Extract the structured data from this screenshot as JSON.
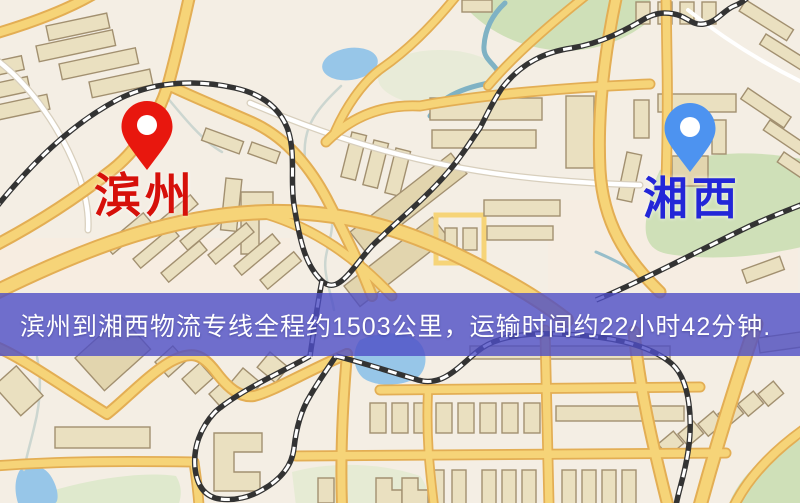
{
  "palette": {
    "origin_pin": "#e8170e",
    "origin_label": "#d6100a",
    "destination_pin": "#4d93f0",
    "destination_label": "#2326d8",
    "banner_bg": "rgba(77,77,197,0.8)",
    "banner_text": "#ffffff",
    "map_base": "#f4eee4",
    "map_patch": "#f8ecdf",
    "road_fill": "#f6d478",
    "road_casing": "#e3ae54",
    "minor_road_fill": "#ffffff",
    "minor_road_casing": "#d8cfbd",
    "building_fill": "#eae0c0",
    "building_dark": "#e2d5ae",
    "building_outline": "#a29070",
    "park": "#cfe0b8",
    "park_light": "#dfe9cd",
    "water": "#97c6e8",
    "stream": "#7fb2c4",
    "railway_dark": "#333333",
    "railway_dash": "#ffffff"
  },
  "map": {
    "origin": {
      "label": "滨州"
    },
    "destination": {
      "label": "湘西"
    }
  },
  "banner": {
    "text": "滨州到湘西物流专线全程约1503公里，运输时间约22小时42分钟."
  }
}
